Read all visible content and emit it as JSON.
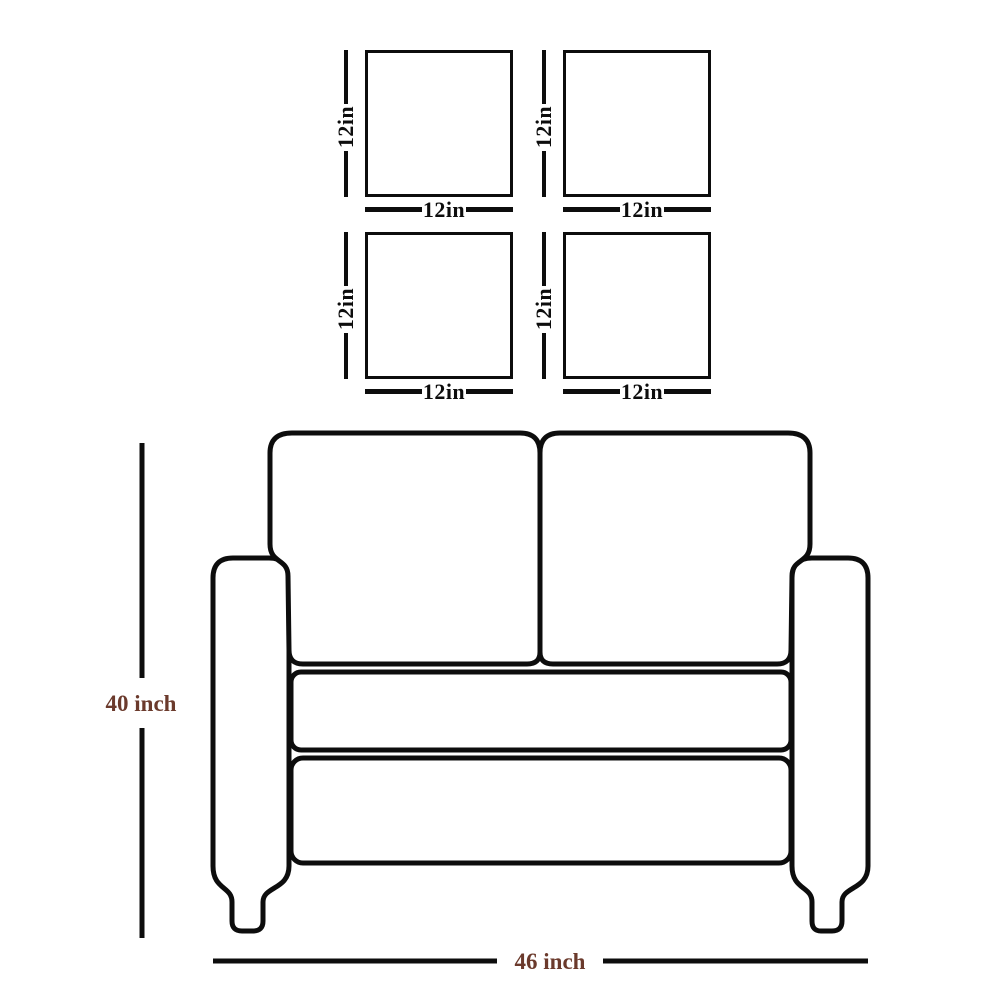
{
  "colors": {
    "line": "#0d0d0d",
    "pillow_label": "#0d0d0d",
    "sofa_label": "#6b3a2c",
    "background": "#ffffff"
  },
  "pillows": [
    {
      "name": "pillow-top-left",
      "height_label": "12in",
      "width_label": "12in"
    },
    {
      "name": "pillow-top-right",
      "height_label": "12in",
      "width_label": "12in"
    },
    {
      "name": "pillow-bottom-left",
      "height_label": "12in",
      "width_label": "12in"
    },
    {
      "name": "pillow-bottom-right",
      "height_label": "12in",
      "width_label": "12in"
    }
  ],
  "sofa": {
    "height_label": "40 inch",
    "width_label": "46 inch"
  }
}
